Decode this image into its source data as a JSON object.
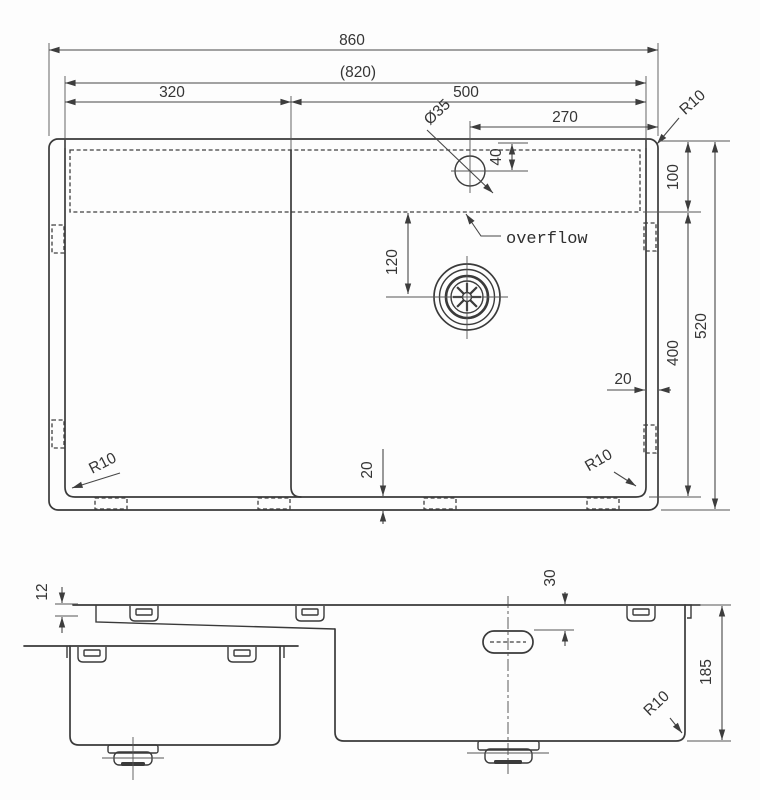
{
  "drawing": {
    "kind": "sink dimensional drawing",
    "top_view": {
      "dim_overall_width": "860",
      "dim_inner_width": "(820)",
      "dim_left_section": "320",
      "dim_right_bowl": "500",
      "dim_faucet_offset_right": "270",
      "dim_faucet_hole_diameter": "Ø35",
      "dim_faucet_offset_top": "40",
      "dim_ledge_height": "100",
      "dim_drain_offset": "120",
      "dim_bowl_height": "400",
      "dim_overall_depth": "520",
      "dim_right_gap": "20",
      "dim_bottom_gap": "20",
      "radius_top_right": "R10",
      "radius_bottom_left": "R10",
      "radius_bottom_right": "R10",
      "label_overflow": "overflow"
    },
    "section_view": {
      "dim_rim_edge": "12",
      "dim_overflow_offset_top": "30",
      "dim_bowl_depth": "185",
      "radius_bottom_right": "R10"
    }
  }
}
